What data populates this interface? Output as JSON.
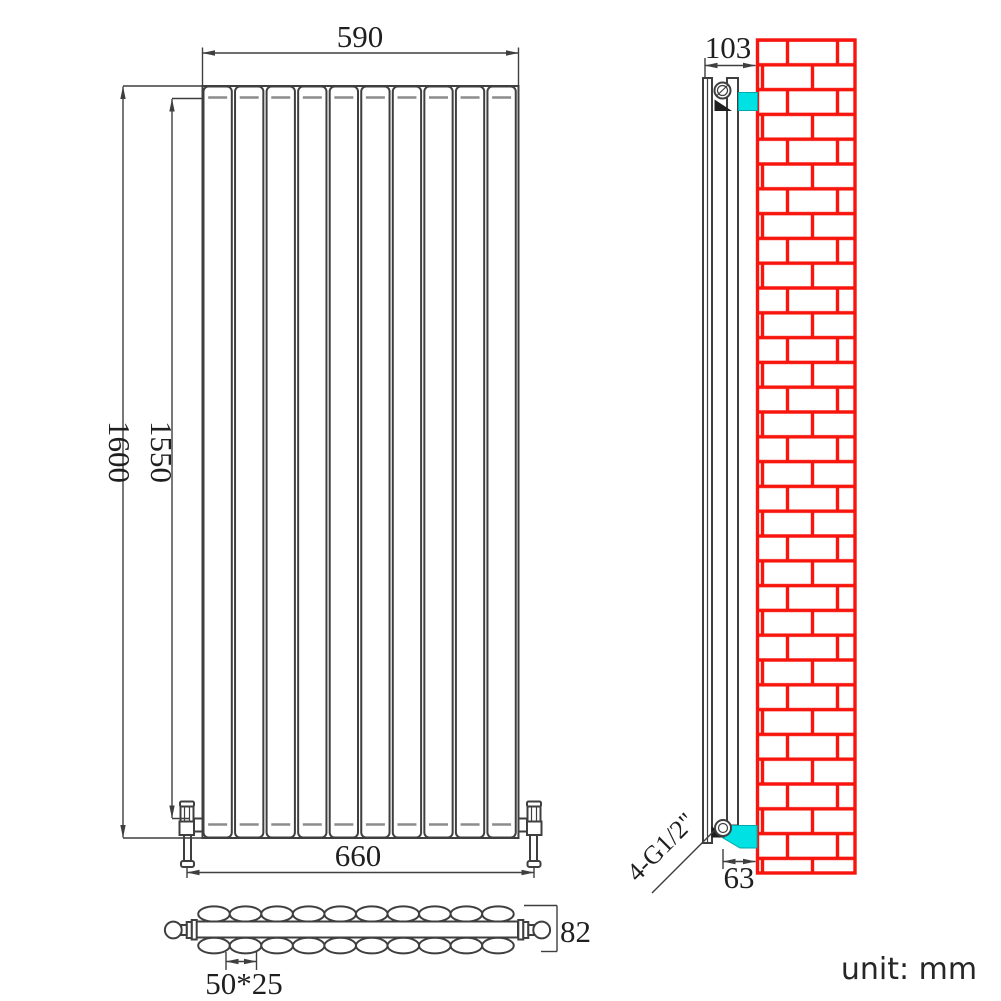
{
  "title": "vertical radiator technical drawing",
  "unit_note": "unit: mm",
  "colors": {
    "line": "#3f3f3f",
    "hidden_line": "#8c8c8c",
    "brick_red": "#f8150d",
    "bracket_cyan": "#00e1e4"
  },
  "front_view": {
    "name": "front elevation",
    "panel_count": 10,
    "dims": {
      "top_width": "590",
      "overall_height": "1600",
      "panel_height": "1550",
      "bottom_width": "660"
    }
  },
  "section_view": {
    "name": "plan section of oval tubes",
    "ovals_per_row": 10,
    "rows": 2,
    "dims": {
      "depth": "82",
      "tube_size": "50*25"
    }
  },
  "side_view": {
    "name": "side elevation on brick wall",
    "dims": {
      "overall_depth": "103",
      "bottom_offset": "63",
      "connection": "4-G1/2\""
    }
  }
}
